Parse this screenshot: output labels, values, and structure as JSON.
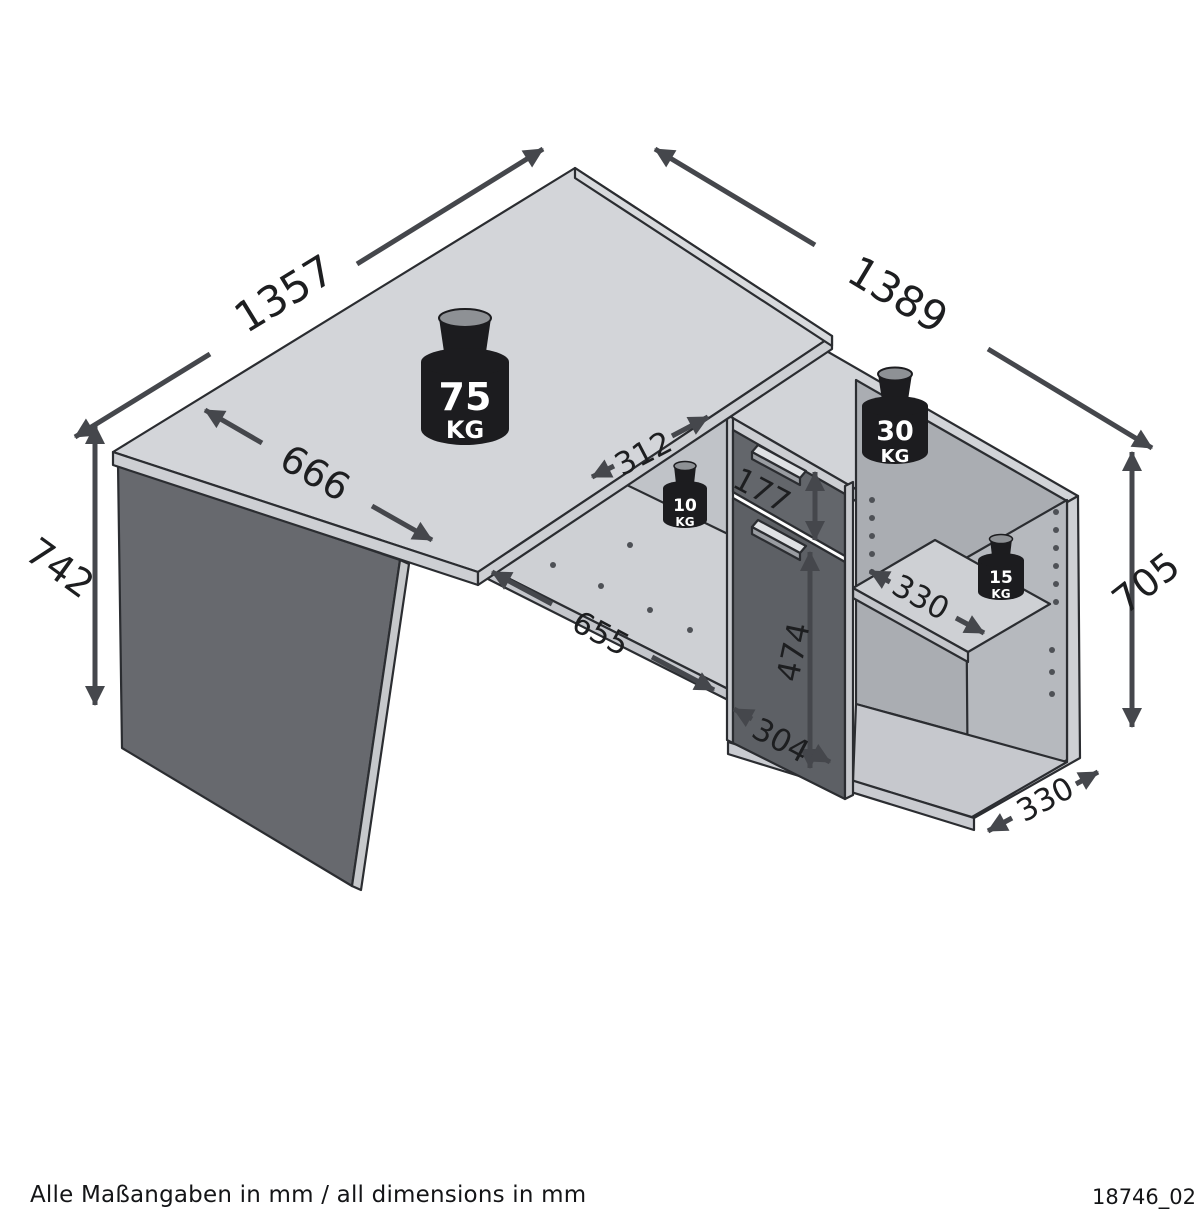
{
  "diagram": {
    "title": "corner-desk-dimension-diagram",
    "dimensions": {
      "desk_length": "1357",
      "sideboard_length": "1389",
      "desk_height": "742",
      "desk_depth": "666",
      "corner_shelf_depth": "312",
      "drawer_front_height": "177",
      "left_compartment_width": "655",
      "door_height": "474",
      "drawer_section_width": "304",
      "right_shelf_depth": "330",
      "sideboard_height": "705",
      "sideboard_depth": "330"
    },
    "load_capacities": {
      "desk_top": {
        "value": "75",
        "unit": "KG"
      },
      "sideboard_top": {
        "value": "30",
        "unit": "KG"
      },
      "corner_shelf": {
        "value": "10",
        "unit": "KG"
      },
      "right_shelf": {
        "value": "15",
        "unit": "KG"
      }
    },
    "footer": {
      "note": "Alle Maßangaben in mm / all dimensions in mm",
      "drawing_number": "18746_02"
    },
    "colors": {
      "surface_light": "#d3d5d9",
      "edge_band": "#cdcfd3",
      "panel_dark": "#67696e",
      "door_dark": "#5d6065",
      "interior_shadow": "#aaadb2",
      "arrow": "#45474c",
      "weight_body": "#1c1c1f",
      "weight_cap": "#8e9195"
    }
  }
}
